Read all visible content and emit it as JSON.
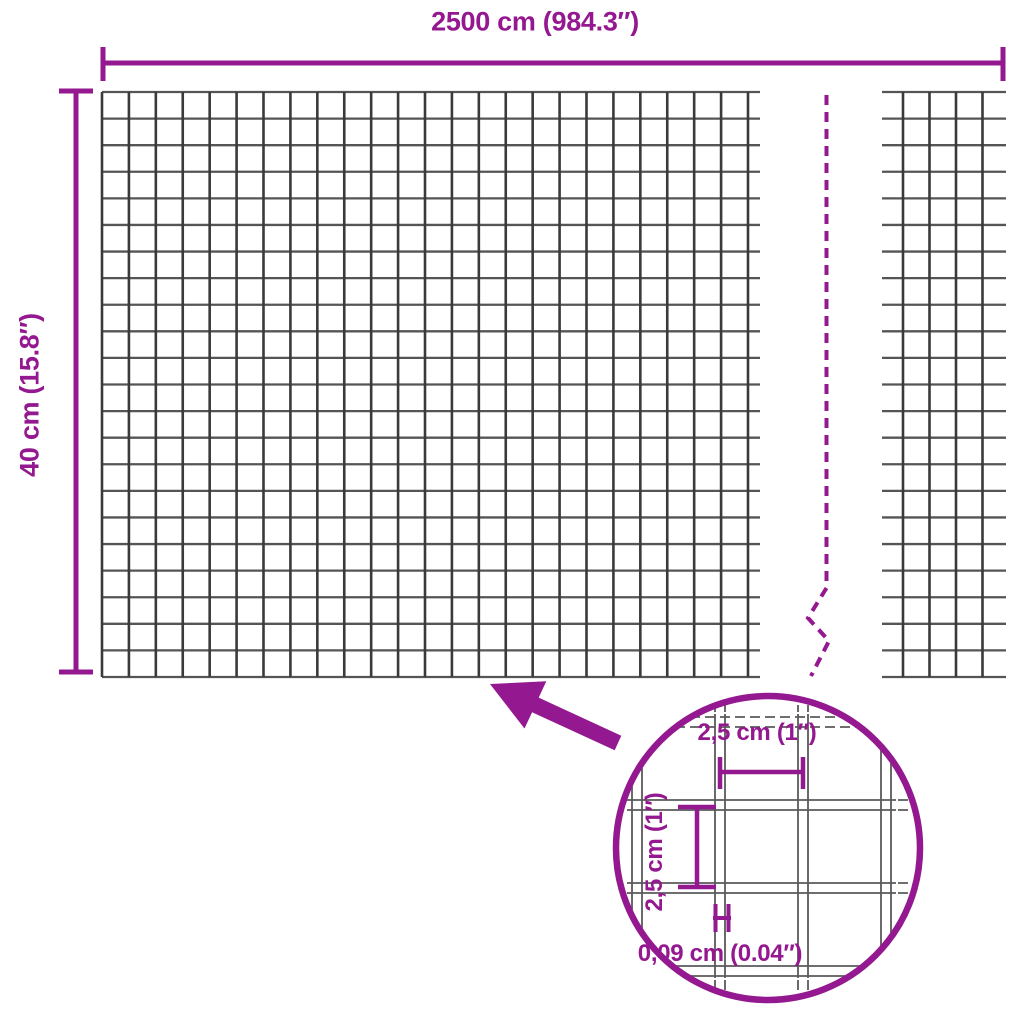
{
  "diagram": {
    "dimensions": {
      "width_label": "2500 cm (984.3″)",
      "height_label": "40 cm (15.8″)"
    },
    "detail": {
      "cell_width_label": "2,5 cm (1″)",
      "cell_height_label": "2,5 cm (1″)",
      "wire_thickness_label": "0,09 cm (0.04″)"
    },
    "colors": {
      "accent": "#94188F",
      "grid_vertical": "#3A3A3A",
      "grid_horizontal": "#555555",
      "detail_wire": "#5A5A5A",
      "background": "#FFFFFF"
    }
  }
}
